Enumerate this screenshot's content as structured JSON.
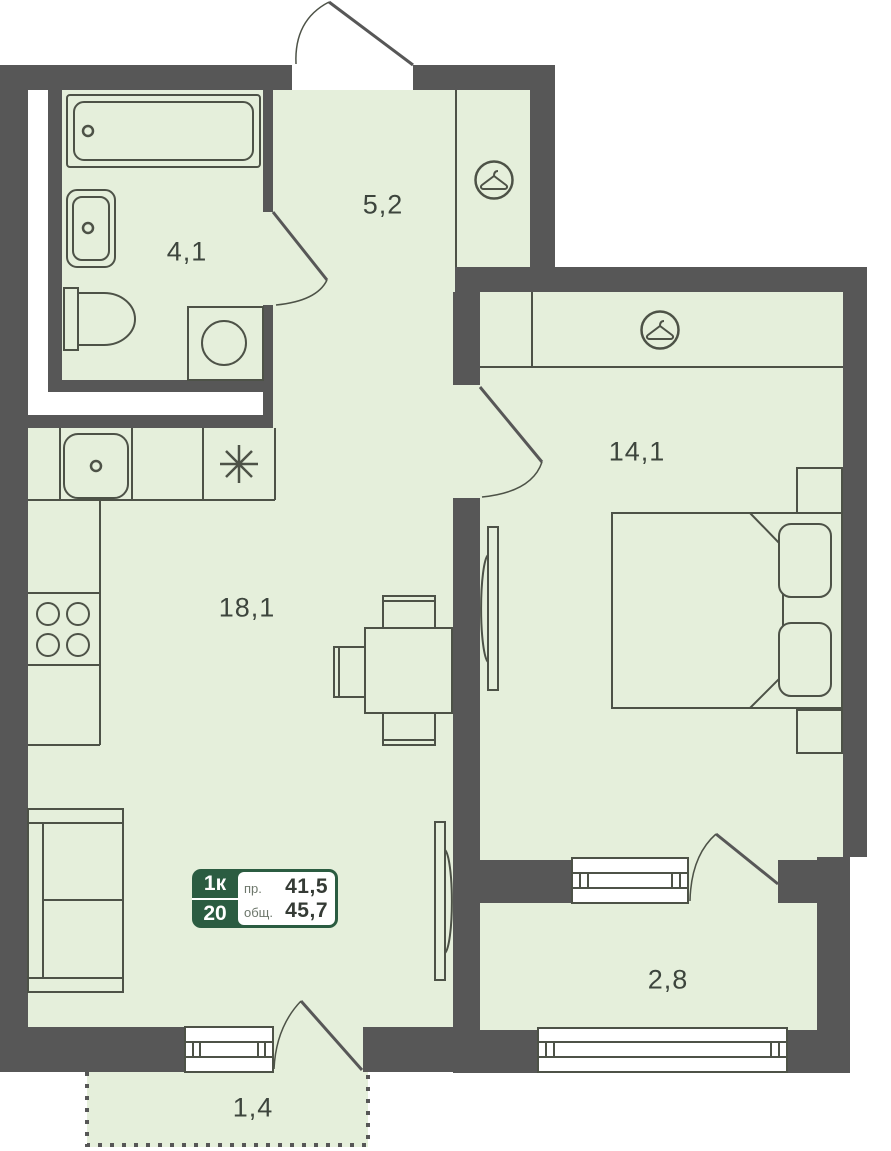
{
  "floorplan": {
    "unit_badge": {
      "rooms_label": "1к",
      "unit_number": "20",
      "living_area_label": "пр.",
      "living_area_value": "41,5",
      "total_area_label": "общ.",
      "total_area_value": "45,7"
    },
    "rooms": [
      {
        "name": "bathroom",
        "area": "4,1"
      },
      {
        "name": "hallway",
        "area": "5,2"
      },
      {
        "name": "bedroom",
        "area": "14,1"
      },
      {
        "name": "living-kitchen",
        "area": "18,1"
      },
      {
        "name": "loggia",
        "area": "2,8"
      },
      {
        "name": "balcony",
        "area": "1,4"
      }
    ],
    "icons": {
      "wardrobe_hallway": "hanger-icon",
      "wardrobe_bedroom": "hanger-icon",
      "stove": "asterisk-stove-icon"
    },
    "colors": {
      "wall": "#575757",
      "floor": "#e5efdb",
      "badge_green": "#2b5c41",
      "furniture_stroke": "#4d5247"
    }
  }
}
